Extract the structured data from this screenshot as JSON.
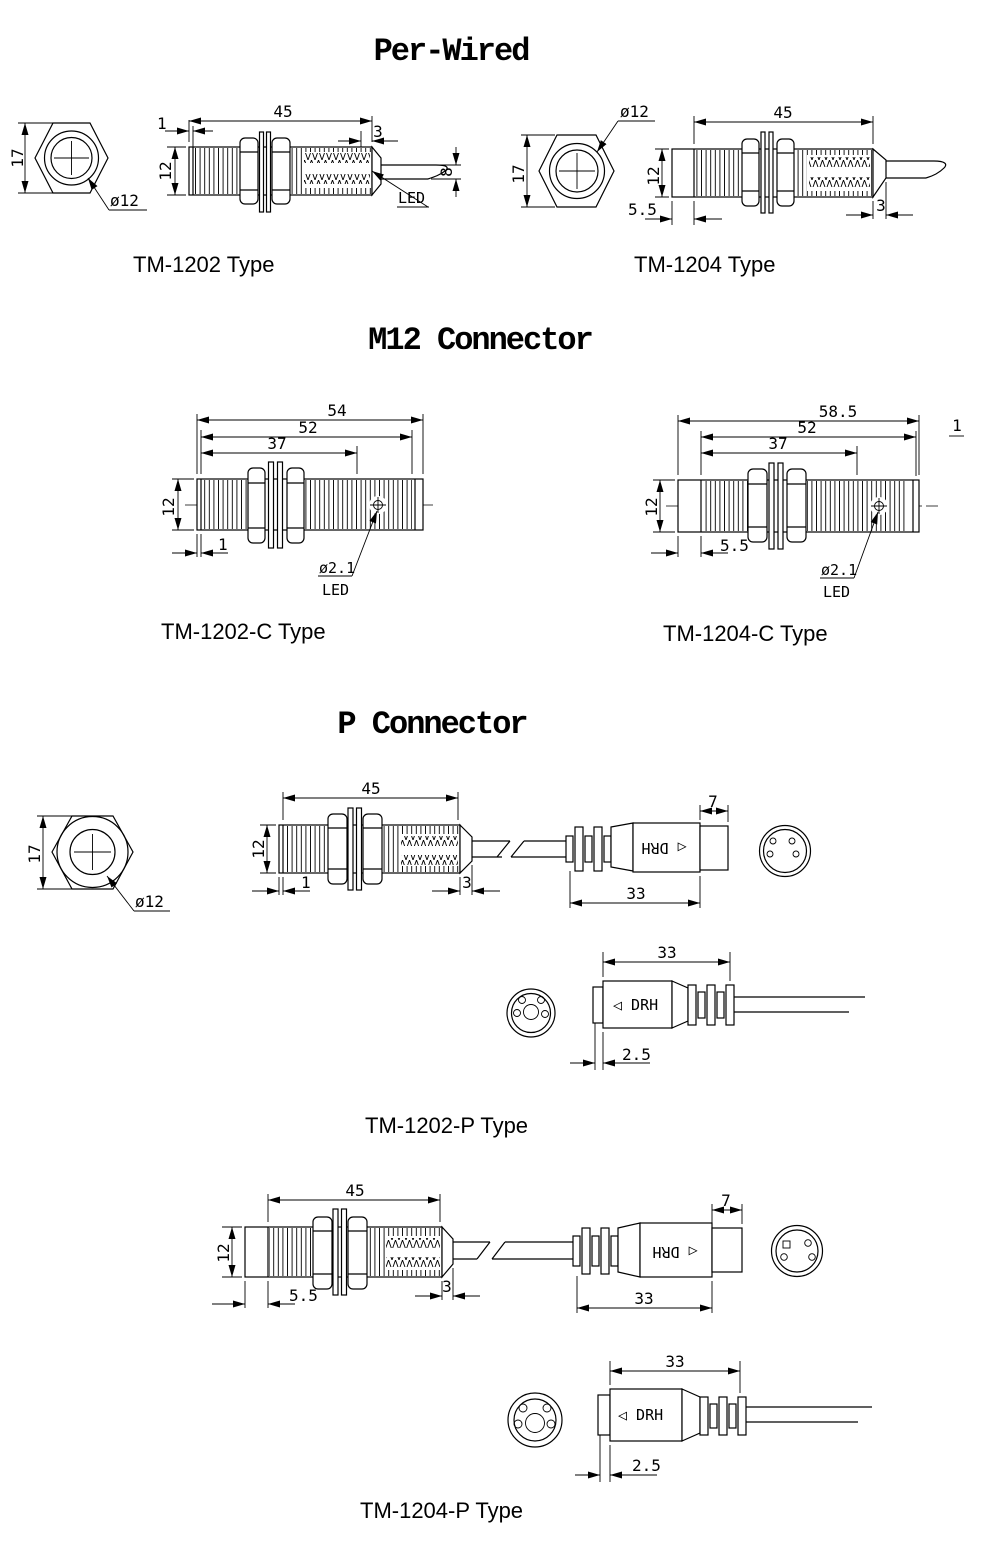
{
  "titles": {
    "per_wired": "Per-Wired",
    "m12": "M12 Connector",
    "p": "P Connector"
  },
  "tm1202": {
    "label": "TM-1202 Type",
    "front": {
      "af": "17",
      "dia": "ø12"
    },
    "dims": {
      "length": "45",
      "tip": "1",
      "rear": "3",
      "body": "12",
      "cable": "8",
      "led": "LED"
    }
  },
  "tm1204": {
    "label": "TM-1204 Type",
    "front": {
      "af": "17",
      "dia": "ø12"
    },
    "dims": {
      "length": "45",
      "head": "5.5",
      "rear": "3",
      "body": "12"
    }
  },
  "tm1202c": {
    "label": "TM-1202-C Type",
    "dims": {
      "overall": "54",
      "body": "52",
      "thread": "37",
      "dia": "12",
      "tip": "1",
      "led_dia": "ø2.1",
      "led": "LED"
    }
  },
  "tm1204c": {
    "label": "TM-1204-C Type",
    "note": "1",
    "dims": {
      "overall": "58.5",
      "body": "52",
      "thread": "37",
      "dia": "12",
      "head": "5.5",
      "led_dia": "ø2.1",
      "led": "LED"
    }
  },
  "p_front": {
    "af": "17",
    "dia": "ø12"
  },
  "tm1202p": {
    "label": "TM-1202-P Type",
    "dims": {
      "length": "45",
      "tip": "1",
      "rear": "3",
      "body": "12",
      "plug_cap": "7",
      "plug_len": "33"
    },
    "plug_text": "◁ DRH",
    "socket": {
      "len": "33",
      "text": "◁ DRH",
      "cap": "2.5"
    }
  },
  "tm1204p": {
    "label": "TM-1204-P Type",
    "dims": {
      "length": "45",
      "head": "5.5",
      "rear": "3",
      "body": "12",
      "plug_cap": "7",
      "plug_len": "33"
    },
    "plug_text": "◁ DRH",
    "socket": {
      "len": "33",
      "text": "◁ DRH",
      "cap": "2.5"
    }
  }
}
